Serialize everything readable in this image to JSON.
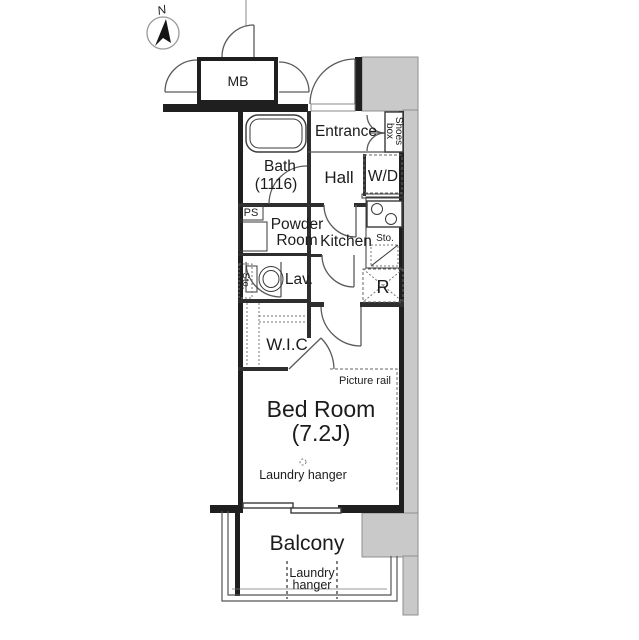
{
  "colors": {
    "wall": "#1f1f1f",
    "interior_wall": "#2e2e2e",
    "corridor_gray": "#c9c9c9",
    "line": "#555555",
    "text": "#1c1c1c"
  },
  "compass": {
    "north_label": "N"
  },
  "labels": {
    "mb": "MB",
    "entrance": "Entrance",
    "shoes_box_line1": "Shoes",
    "shoes_box_line2": "box",
    "bath_line1": "Bath",
    "bath_line2": "(1116)",
    "hall": "Hall",
    "washer_dryer": "W/D",
    "pipe_space": "PS",
    "powder_line1": "Powder",
    "powder_line2": "Room",
    "kitchen": "Kitchen",
    "kitchen_storage": "Sto.",
    "refrigerator": "R",
    "lavatory": "Lav.",
    "lav_storage": "Sto.",
    "walk_in_closet": "W.I.C",
    "picture_rail": "Picture rail",
    "bedroom_line1": "Bed Room",
    "bedroom_line2": "(7.2J)",
    "bedroom_laundry_hanger": "Laundry hanger",
    "balcony": "Balcony",
    "balcony_laundry_line1": "Laundry",
    "balcony_laundry_line2": "hanger"
  }
}
